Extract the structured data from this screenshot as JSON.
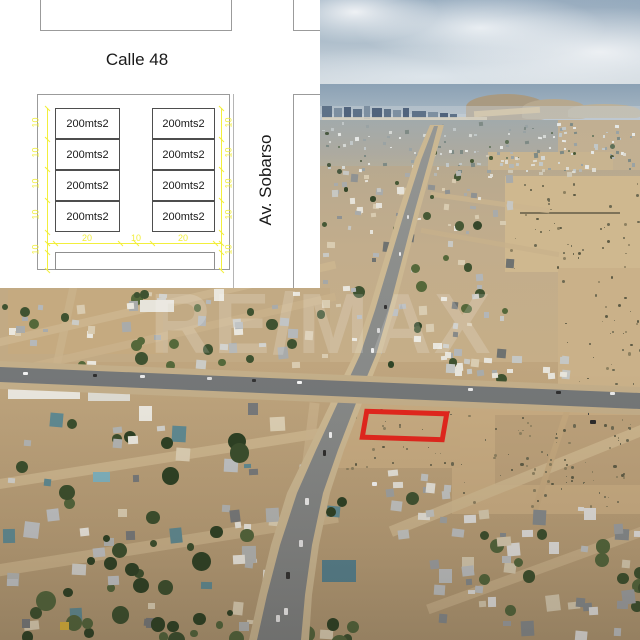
{
  "plan": {
    "street_top_label": "Calle 48",
    "street_right_label": "Av. Sobarso",
    "lot_labels": [
      "200mts2",
      "200mts2",
      "200mts2",
      "200mts2",
      "200mts2",
      "200mts2",
      "200mts2",
      "200mts2"
    ],
    "dims_left": [
      "10",
      "10",
      "10",
      "10",
      "10"
    ],
    "dims_right": [
      "10",
      "10",
      "10",
      "10",
      "10"
    ],
    "dims_bottom": [
      "20",
      "10",
      "20"
    ],
    "dim_line_color": "#f1ee33"
  },
  "photo": {
    "watermark_text": "RE/MAX",
    "property_outline_color": "#e3261d"
  }
}
